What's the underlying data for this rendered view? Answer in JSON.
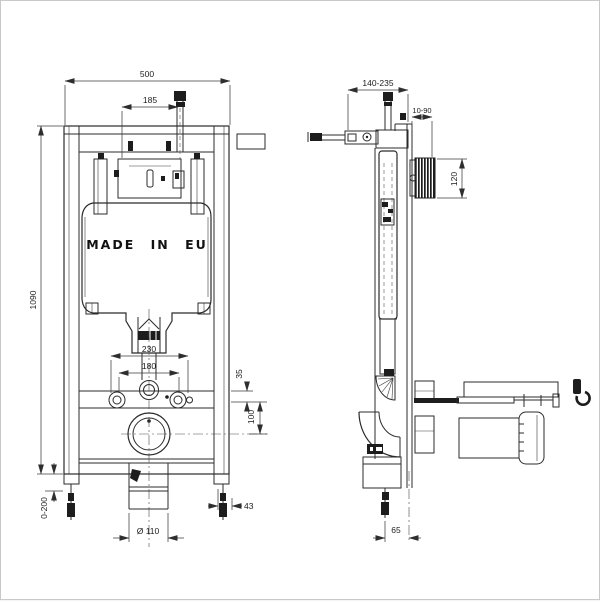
{
  "drawing": {
    "brand_text": "MADE IN EU",
    "front_view": {
      "width": "500",
      "valve_offset": "185",
      "height": "1090",
      "leg_adjust": "0-200",
      "fixing_outer": "230",
      "fixing_inner": "180",
      "flush_drop": "35",
      "drain_drop": "100",
      "leg_offset": "43",
      "drain_diameter": "Ø 110"
    },
    "side_view": {
      "depth_range": "140-235",
      "wall_gap": "10-90",
      "plate_height": "120",
      "outlet_offset": "65"
    },
    "colors": {
      "line": "#2b2b2b",
      "background": "#ffffff",
      "page_border": "#c9c9c9"
    }
  }
}
